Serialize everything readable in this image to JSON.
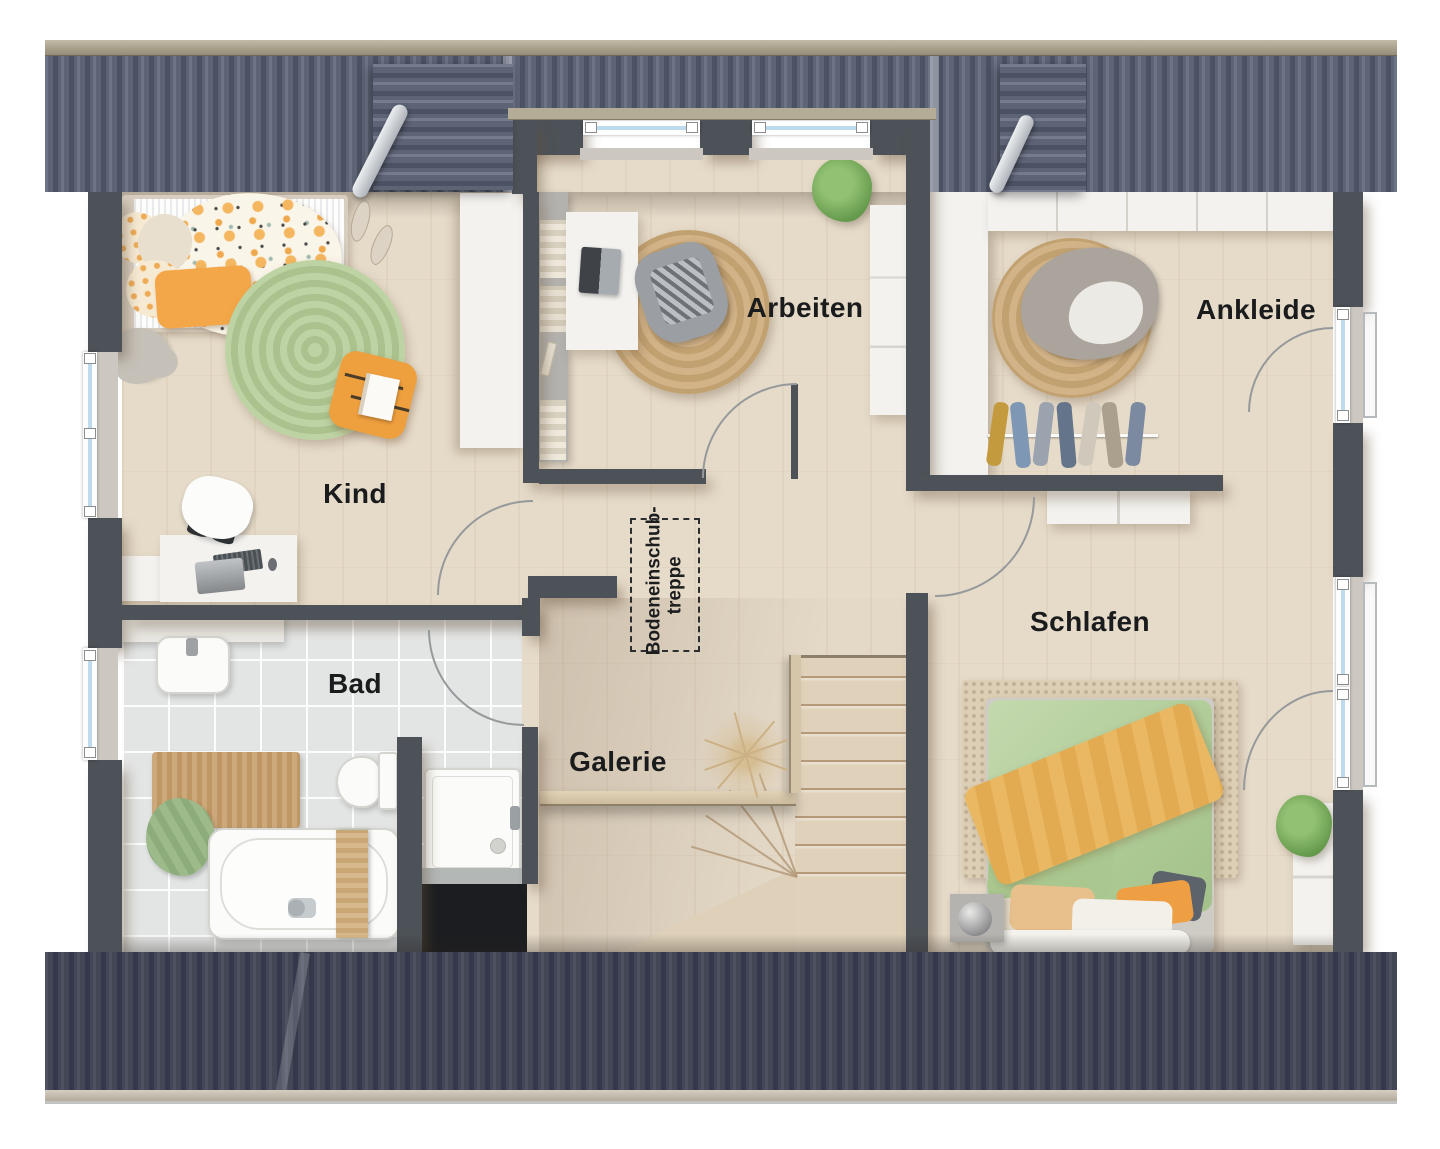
{
  "floorplan": {
    "rooms": {
      "kind": {
        "label": "Kind"
      },
      "arbeiten": {
        "label": "Arbeiten"
      },
      "ankleide": {
        "label": "Ankleide"
      },
      "schlafen": {
        "label": "Schlafen"
      },
      "bad": {
        "label": "Bad"
      },
      "galerie": {
        "label": "Galerie"
      }
    },
    "attic_hatch": {
      "label_line1": "Bodeneinschub-",
      "label_line2": "treppe"
    },
    "colors": {
      "roof_top": "#5d6476",
      "roof_bottom": "#434654",
      "ridge": "#b1a894",
      "wall": "#4d5258",
      "wood_floor": "#e6dbc9",
      "tile_floor": "#e3e5e4",
      "window_glass": "#bedbed",
      "accent_orange": "#f0a44c",
      "accent_green_rug": "#b5cf9a",
      "accent_green_bed": "#b6d0a0",
      "jute": "#c8a97c",
      "label_text": "#1a1b1d"
    }
  }
}
